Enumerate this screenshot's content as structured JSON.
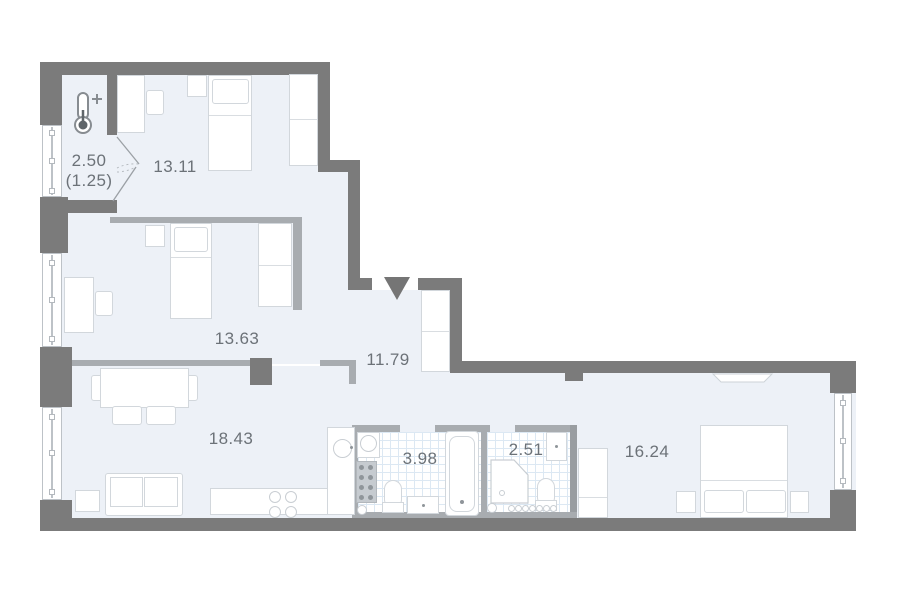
{
  "plan": {
    "type": "apartment-floor-plan",
    "rooms": [
      {
        "id": "balcony",
        "label": "2.50",
        "sublabel": "(1.25)"
      },
      {
        "id": "bedroom-top",
        "label": "13.11"
      },
      {
        "id": "bedroom-middle",
        "label": "13.63"
      },
      {
        "id": "hallway",
        "label": "11.79"
      },
      {
        "id": "living-kitchen",
        "label": "18.43"
      },
      {
        "id": "bathroom",
        "label": "3.98"
      },
      {
        "id": "wc",
        "label": "2.51"
      },
      {
        "id": "bedroom-right",
        "label": "16.24"
      }
    ],
    "icons": {
      "thermometer": "thermometer-plus-icon",
      "entry": "entry-arrow-icon"
    },
    "colors": {
      "wall_dark": "#7b7b7b",
      "wall_light": "#a8acb0",
      "floor": "#edf1f7",
      "tile_line": "#dce8f3",
      "furniture_stroke": "#d2d7dc",
      "label_text": "#6c7278",
      "background": "#ffffff"
    }
  }
}
